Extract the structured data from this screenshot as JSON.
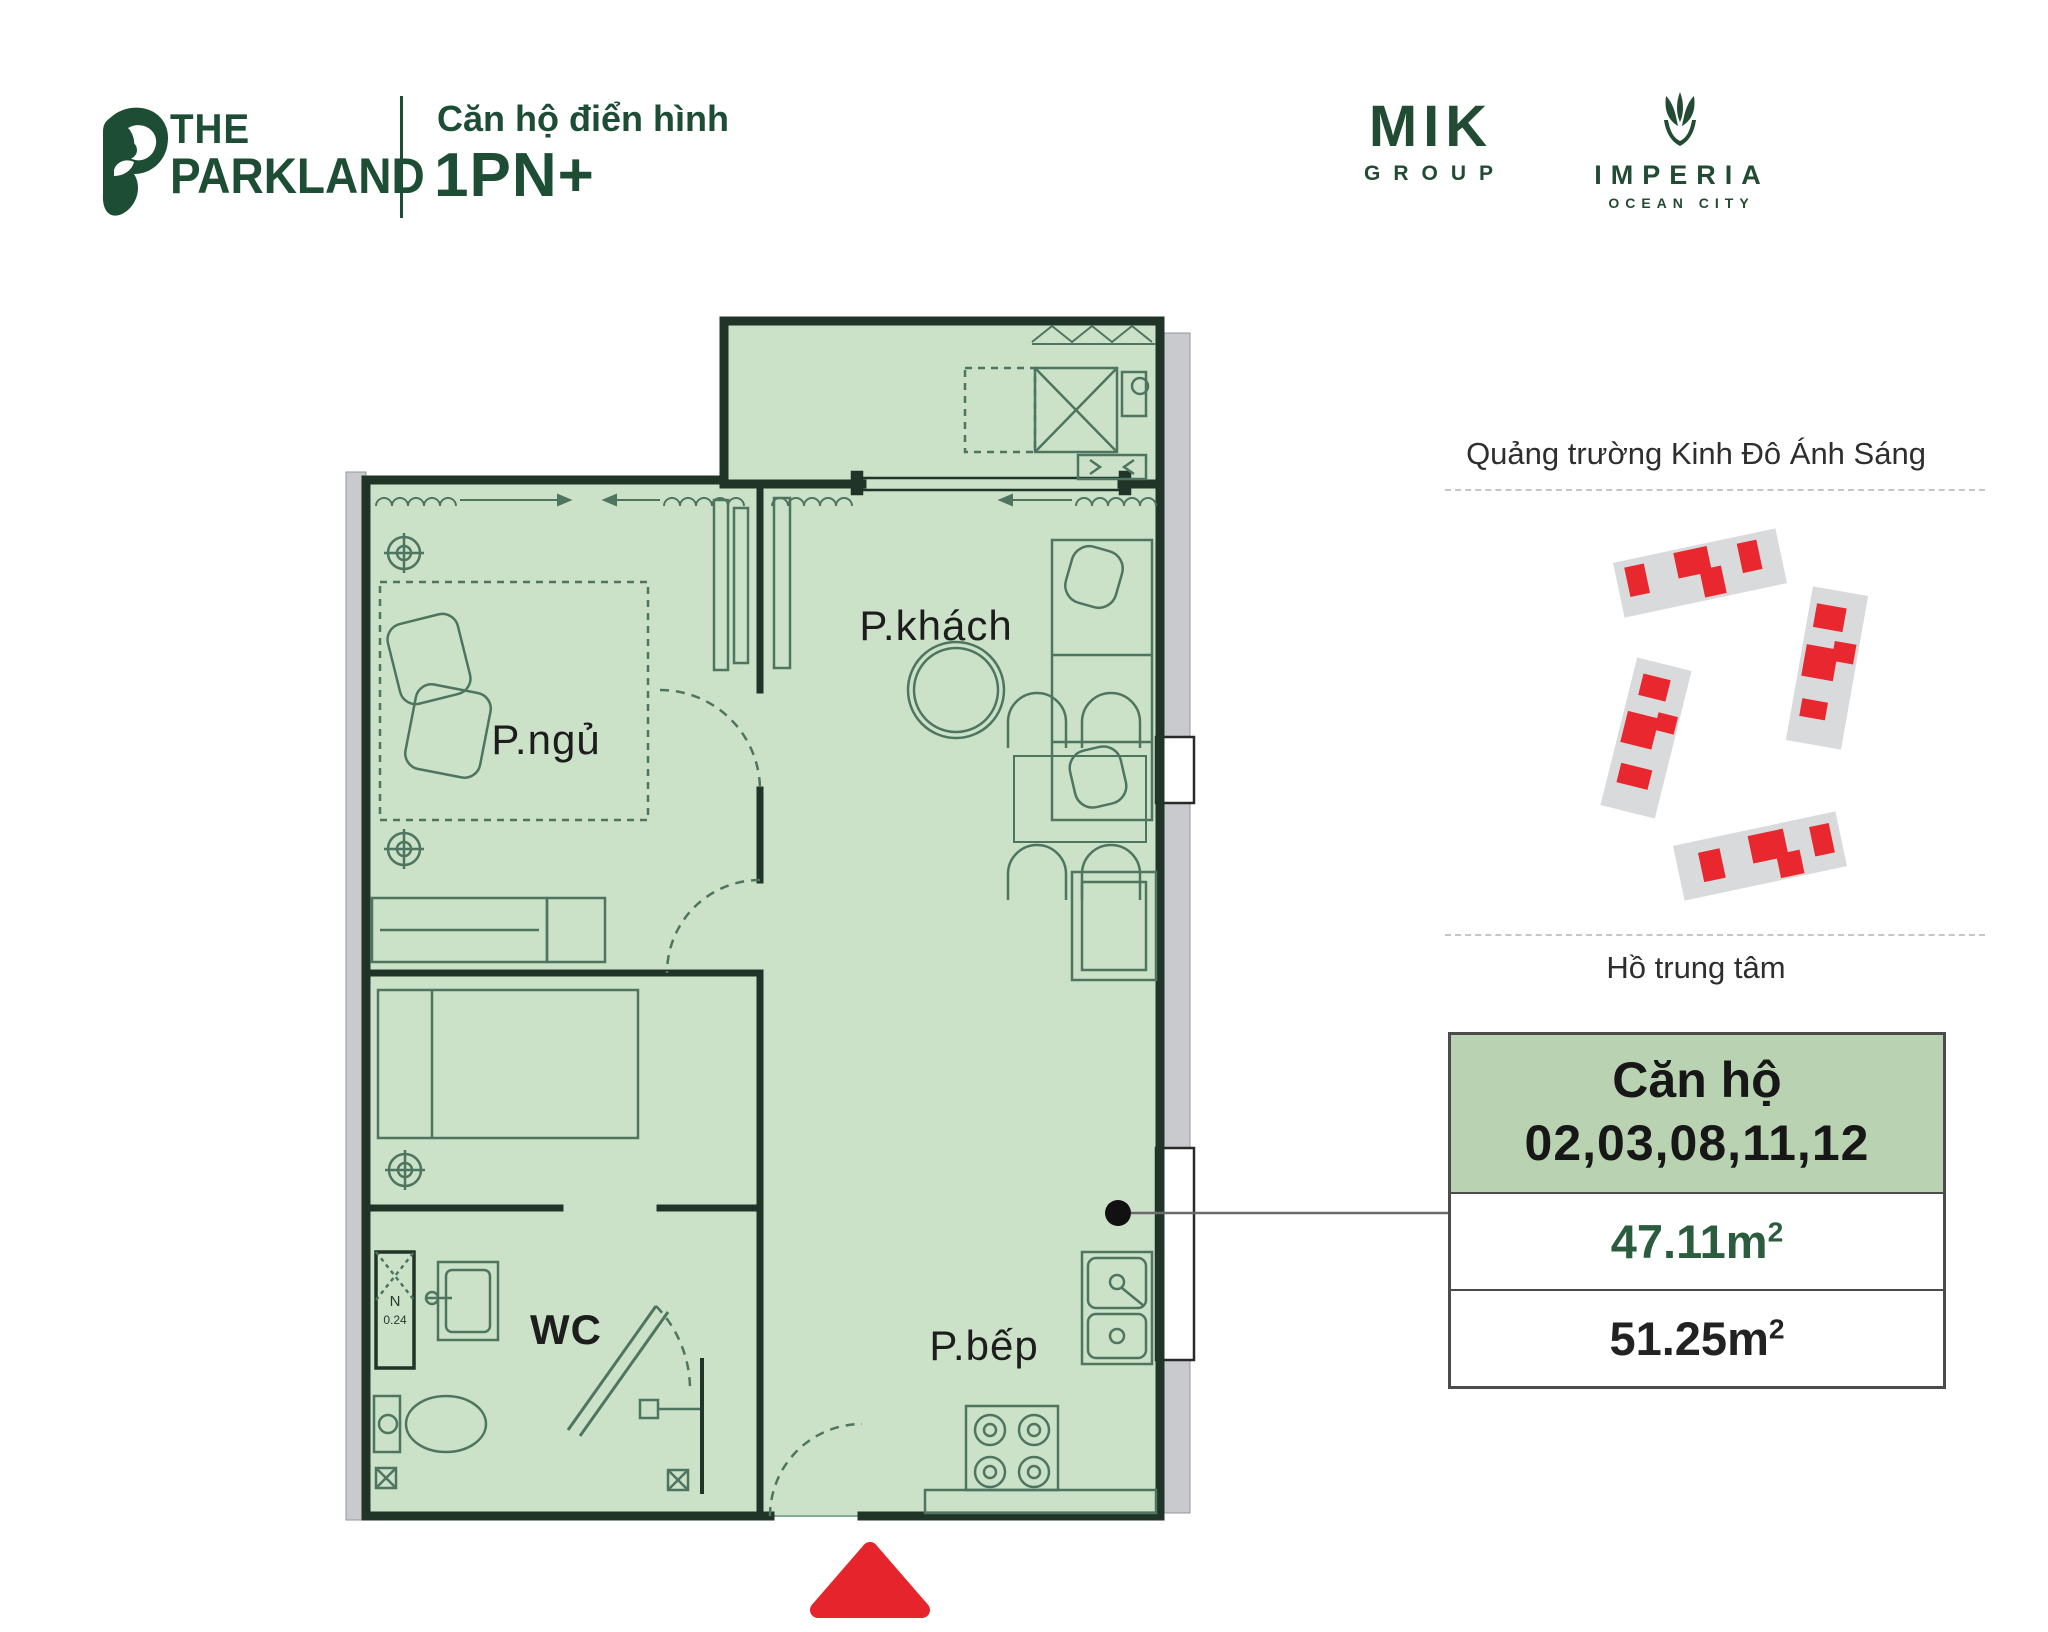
{
  "header": {
    "brand": {
      "line1": "THE",
      "line2": "PARKLAND"
    },
    "subtitle": "Căn hộ điển hình",
    "unit_type": "1PN+",
    "logo_mik": {
      "name": "MIK",
      "sub": "GROUP"
    },
    "logo_imperia": {
      "name": "IMPERIA",
      "sub": "OCEAN CITY"
    }
  },
  "floor_plan": {
    "rooms": [
      {
        "id": "bedroom",
        "label": "P.ngủ"
      },
      {
        "id": "living",
        "label": "P.khách"
      },
      {
        "id": "wc",
        "label": "WC"
      },
      {
        "id": "kitchen",
        "label": "P.bếp"
      }
    ],
    "shaft": {
      "label": "N",
      "value": "0.24"
    }
  },
  "sidebar": {
    "top_label": "Quảng trường Kinh Đô Ánh Sáng",
    "bottom_label": "Hồ trung tâm",
    "info_box": {
      "title": "Căn hộ",
      "units": "02,03,08,11,12",
      "area_carpet": "47.11m",
      "area_gross": "51.25m",
      "sup": "2"
    }
  },
  "colors": {
    "brand_green": "#1d4d34",
    "plan_fill": "#cbe2c8",
    "wall": "#203427",
    "furniture_line": "#4e7560",
    "exterior_gray": "#c9cacd",
    "highlight_red": "#e6242c",
    "info_header_bg": "#b9d3b2",
    "area_green": "#2b5c3e",
    "building_gray": "#d9dadc"
  }
}
